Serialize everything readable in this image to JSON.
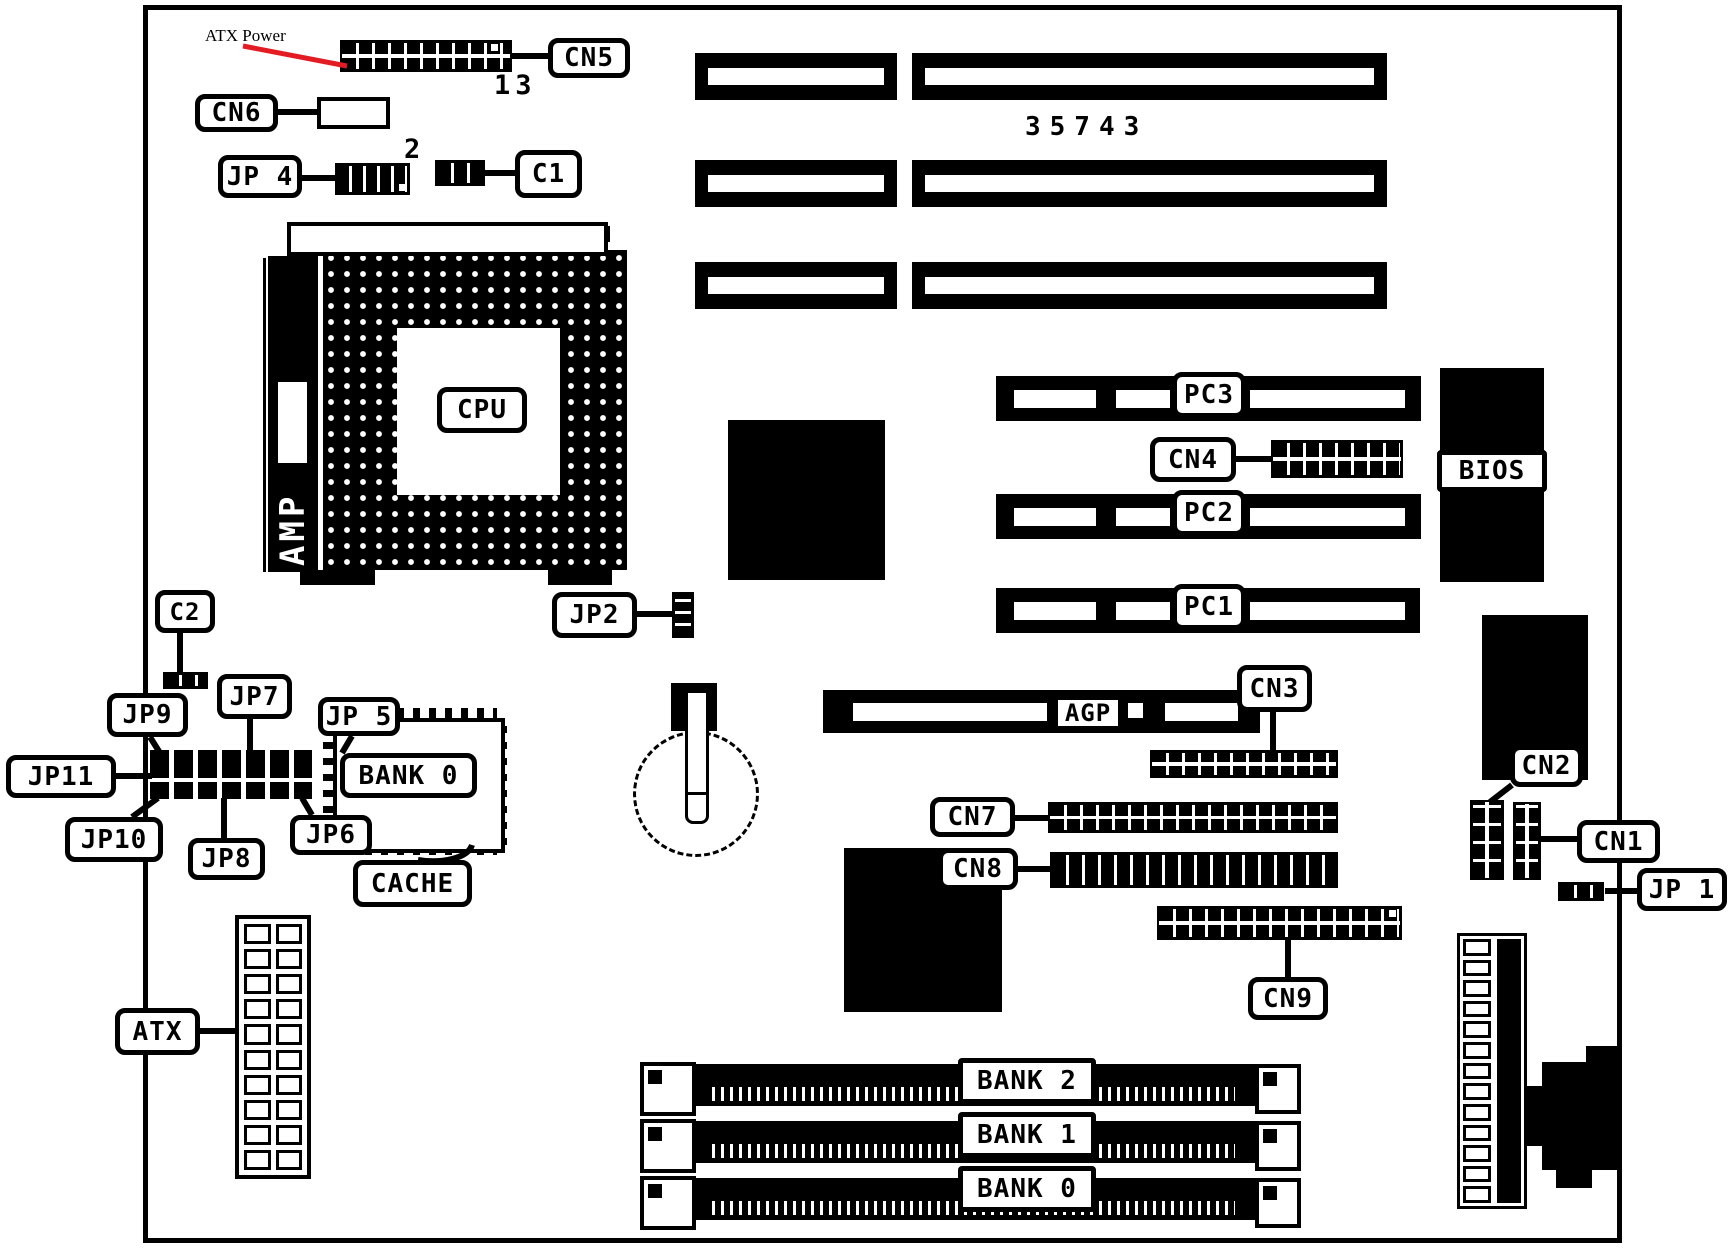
{
  "colors": {
    "ink": "#000000",
    "paper": "#ffffff",
    "arrow_red": "#e31c23"
  },
  "texts": {
    "atx_power_note": "ATX Power",
    "cn5_pin": "13",
    "jp4_pin": "2",
    "part_number": "35743"
  },
  "labels": {
    "cn5": "CN5",
    "cn6": "CN6",
    "jp4": "JP 4",
    "c1": "C1",
    "cpu": "CPU",
    "amp": "AMP",
    "jp2": "JP2",
    "c2": "C2",
    "jp9": "JP9",
    "jp7": "JP7",
    "jp5": "JP 5",
    "jp11": "JP11",
    "jp10": "JP10",
    "jp8": "JP8",
    "jp6": "JP6",
    "bank0_cache": "BANK 0",
    "cache": "CACHE",
    "atx": "ATX",
    "pc3": "PC3",
    "pc2": "PC2",
    "pc1": "PC1",
    "cn4": "CN4",
    "bios": "BIOS",
    "agp": "AGP",
    "cn3": "CN3",
    "cn7": "CN7",
    "cn8": "CN8",
    "cn9": "CN9",
    "cn2": "CN2",
    "cn1": "CN1",
    "jp1": "JP 1",
    "bank2": "BANK 2",
    "bank1": "BANK 1",
    "bank0": "BANK 0"
  }
}
